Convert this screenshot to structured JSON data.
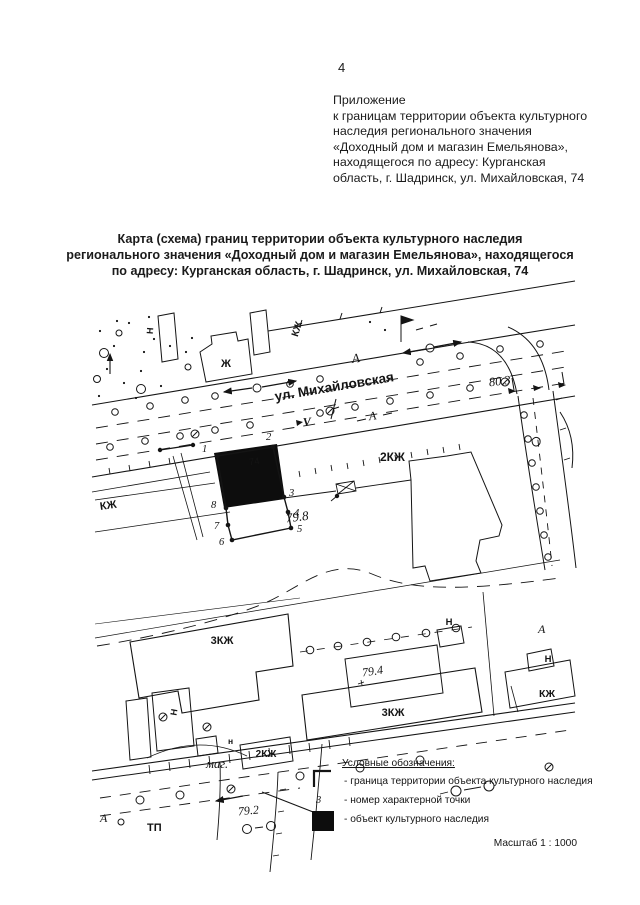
{
  "page": {
    "number": "4",
    "annex": {
      "lines": [
        "Приложение",
        "к границам территории объекта культурного",
        "наследия регионального значения",
        "«Доходный дом и магазин Емельянова»,",
        "находящегося по адресу: Курганская",
        "область, г. Шадринск, ул. Михайловская, 74"
      ]
    },
    "title": {
      "lines": [
        "Карта (схема) границ территории объекта культурного наследия",
        "регионального значения «Доходный дом и магазин Емельянова», находящегося",
        "по адресу: Курганская область, г. Шадринск, ул. Михайловская, 74"
      ]
    }
  },
  "map": {
    "street_label": "ул. Михайловская",
    "labels": {
      "zh_top": "Ж",
      "n_top": "Н",
      "kzh_top": "КЖ",
      "a_street_upper": "А",
      "a_street_lower": "А",
      "v_mark": "V",
      "elev_80_3": "80.3",
      "kzh2_main": "2КЖ",
      "elev_79_8": "79.8",
      "kzh_left": "КЖ",
      "kzh3_west": "3КЖ",
      "elev_79_4": "79.4",
      "n_yard": "Н",
      "kzh3_south": "3КЖ",
      "a_lane": "А",
      "n_lane": "Н",
      "kzh_lane": "КЖ",
      "n_small": "Н",
      "n_bottom": "н",
      "kzh2_small": "2КЖ",
      "mag": "маг.",
      "elev_79_2": "79.2",
      "tp": "ТП",
      "a_bottom": "А",
      "object_number": "74"
    },
    "points": {
      "p1": "1",
      "p2": "2",
      "p3": "3",
      "p4": "4",
      "p5": "5",
      "p6": "6",
      "p7": "7",
      "p8": "8"
    }
  },
  "legend": {
    "heading": "Условные обозначения:",
    "point_symbol": "3",
    "items": [
      "- граница территории объекта культурного наследия",
      "- номер характерной точки",
      "- объект   культурного наследия"
    ],
    "scale": "Масштаб 1 : 1000"
  },
  "colors": {
    "ink": "#141414",
    "object_fill": "#0d0d0d"
  }
}
